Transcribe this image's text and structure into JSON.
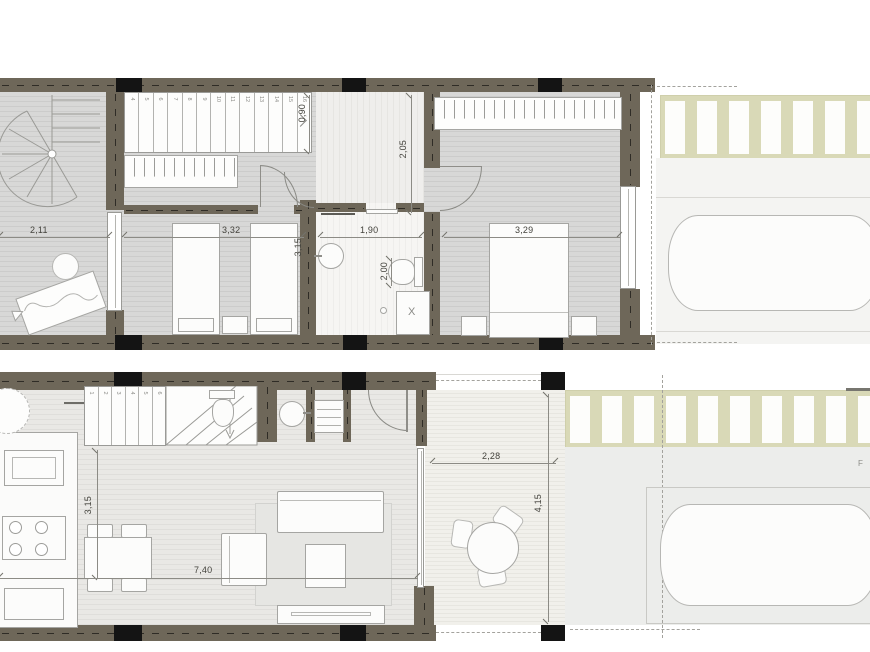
{
  "plan": {
    "upper": {
      "dims": {
        "lounge_width": "2,11",
        "landing_width": "0,90",
        "hall_length": "2,05",
        "bedroom2_width": "3,32",
        "bedroom2_depth": "3,15",
        "bath_width": "1,90",
        "bath_depth": "2,00",
        "bedroom1_width": "3,29"
      },
      "stair_treads": [
        "4",
        "5",
        "6",
        "7",
        "8",
        "9",
        "10",
        "11",
        "12",
        "13",
        "14",
        "15",
        "16"
      ],
      "shower_mark": "X"
    },
    "ground": {
      "dims": {
        "living_depth": "3,15",
        "living_width": "7,40",
        "terrace_width": "2,28",
        "terrace_depth": "4,15"
      },
      "stair_treads": [
        "1",
        "2",
        "3",
        "4",
        "5",
        "6"
      ]
    },
    "site": {
      "edge_label": "F"
    }
  },
  "colors": {
    "wall": "#6e6759",
    "column": "#141414",
    "pergola": "#d9d9b7",
    "floor": "#d8d8d7",
    "deck": "#f1f0eb",
    "dimension_text": "#44433d"
  }
}
